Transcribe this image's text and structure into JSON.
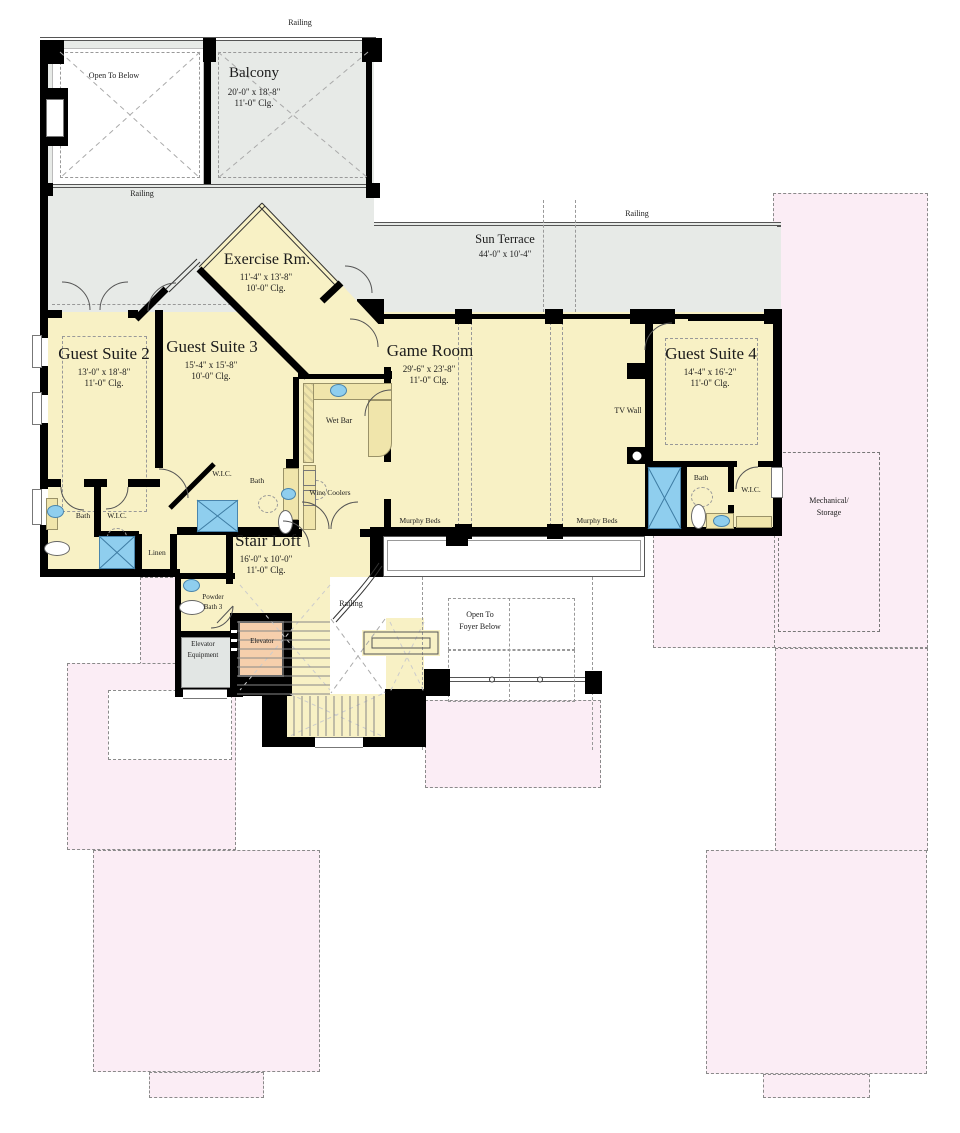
{
  "colors": {
    "c-room": "#F8F1C5",
    "c-terrace": "#E7EAE7",
    "c-pink": "#FBEDF5",
    "c-shower": "#8FCEEE",
    "c-cab": "#F6CFAC",
    "c-equip": "#E2E6E4",
    "c-counter": "#F0E5AB",
    "c-wall": "#000000"
  },
  "rooms": {
    "balcony": {
      "name": "Balcony",
      "dims": "20'-0\" x 18'-8\"",
      "clg": "11'-0\" Clg."
    },
    "sun_terrace": {
      "name": "Sun Terrace",
      "dims": "44'-0\" x 10'-4\""
    },
    "exercise": {
      "name": "Exercise Rm.",
      "dims": "11'-4\" x 13'-8\"",
      "clg": "10'-0\" Clg."
    },
    "guest_suite_2": {
      "name": "Guest Suite 2",
      "dims": "13'-0\" x 18'-8\"",
      "clg": "11'-0\" Clg."
    },
    "guest_suite_3": {
      "name": "Guest Suite 3",
      "dims": "15'-4\" x 15'-8\"",
      "clg": "10'-0\" Clg."
    },
    "game_room": {
      "name": "Game Room",
      "dims": "29'-6\" x 23'-8\"",
      "clg": "11'-0\" Clg."
    },
    "guest_suite_4": {
      "name": "Guest Suite 4",
      "dims": "14'-4\" x 16'-2\"",
      "clg": "11'-0\" Clg."
    },
    "stair_loft": {
      "name": "Stair Loft",
      "dims": "16'-0\" x 10'-0\"",
      "clg": "11'-0\" Clg."
    }
  },
  "labels": {
    "railing": "Railing",
    "open_to_below": "Open To Below",
    "open_to_foyer_1": "Open To",
    "open_to_foyer_2": "Foyer Below",
    "wet_bar": "Wet Bar",
    "wine_coolers": "Wine Coolers",
    "murphy_beds": "Murphy Beds",
    "tv_wall": "TV Wall",
    "bath": "Bath",
    "wic": "W.I.C.",
    "linen": "Linen",
    "powder_1": "Powder",
    "powder_2": "Bath 3",
    "elev_equip_1": "Elevator",
    "elev_equip_2": "Equipment",
    "elevator": "Elevator",
    "mechanical_1": "Mechanical/",
    "mechanical_2": "Storage"
  }
}
